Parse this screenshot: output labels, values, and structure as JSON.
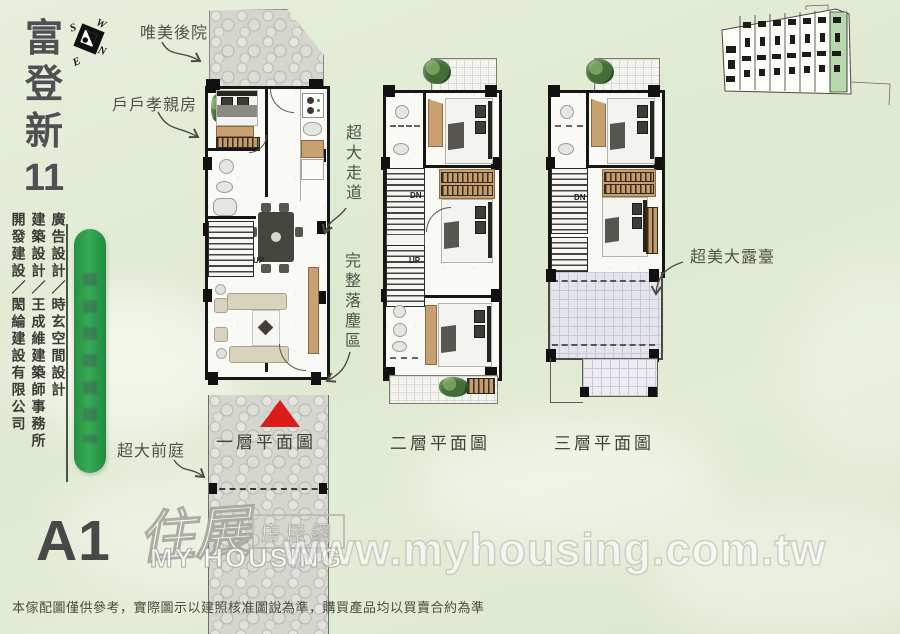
{
  "title": {
    "chars": [
      "富",
      "登",
      "新",
      "11"
    ]
  },
  "unit_label": "A1",
  "compass": {
    "n": "N",
    "s": "S",
    "e": "E",
    "w": "W"
  },
  "credits": [
    "開發建設／閎綸建設有限公司",
    "建築設計／王成維建築師事務所",
    "廣告設計／時玄空間設計"
  ],
  "annotations": {
    "backyard": "唯美後院",
    "parents_room": "戶戶孝親房",
    "walkway": "超大走道",
    "foyer": "完整落塵區",
    "front_yard": "超大前庭",
    "terrace": "超美大露臺"
  },
  "floors": [
    {
      "label": "一層平面圖",
      "up": "UP"
    },
    {
      "label": "二層平面圖",
      "dn": "DN",
      "up": "UP"
    },
    {
      "label": "三層平面圖",
      "dn": "DN"
    }
  ],
  "watermark": {
    "logo_zh": "住展",
    "logo_sub": "房屋網",
    "logo_en": "MY HOUSING",
    "url": "www.myhousing.com.tw"
  },
  "disclaimer": "本傢配圖僅供參考，實際圖示以建照核准圖說為準，購買產品均以買賣合約為準",
  "colors": {
    "accent_green": "#2f9e50",
    "site_highlight_green": "#b7d8ac",
    "entrance_red": "#dc1b1b",
    "background_green": "#e3ecd6"
  }
}
